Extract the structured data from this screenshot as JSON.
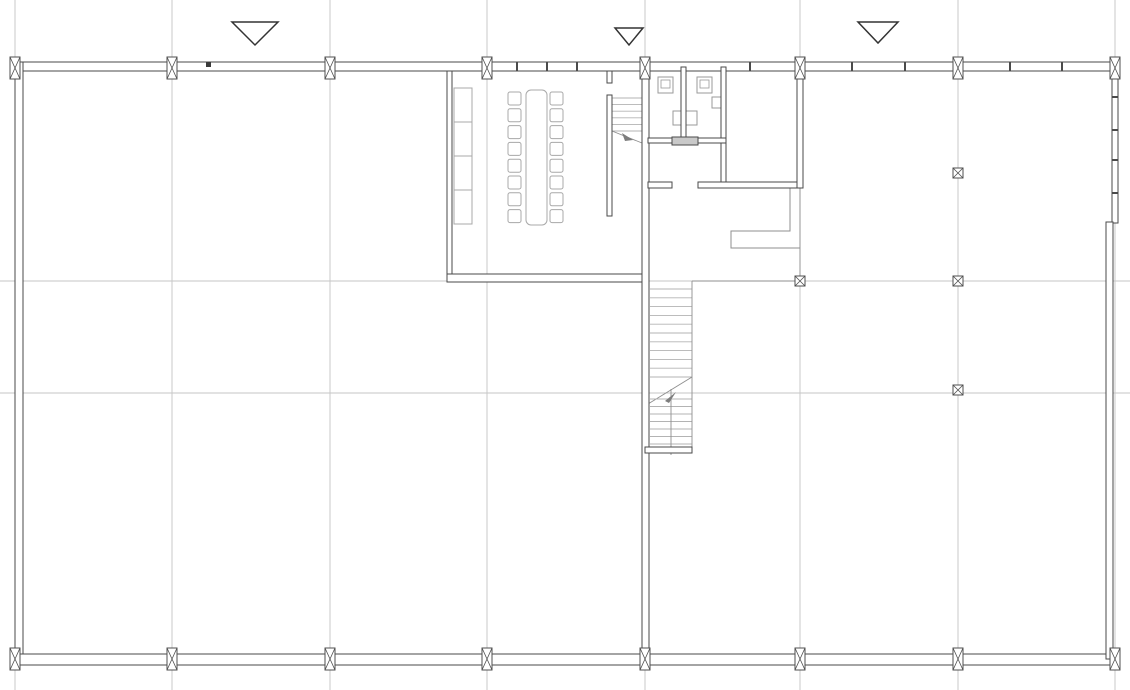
{
  "colors": {
    "background": "#ffffff",
    "grid": "#c5c5c5",
    "wall_stroke": "#4a4a4a",
    "wall_fill": "#ffffff",
    "wall_light": "#7d7d7d",
    "edge_line": "#8f8f8f",
    "tread": "#b3b3b3",
    "furniture": "#a8a8a8",
    "fixture": "#9a9a9a",
    "marker": "#4f4f4f",
    "triangle": "#333333",
    "dot": "#3a3a3a",
    "thick_fill": "#c9c9c9"
  },
  "plan": {
    "canvas": {
      "w": 1130,
      "h": 690
    },
    "gridlines": {
      "vertical_x": [
        15,
        172,
        330,
        487,
        645,
        800,
        958,
        1115
      ],
      "horizontal_y": [
        281,
        393
      ]
    },
    "triangles": [
      {
        "name": "section-marker-large-left",
        "points": "232,22 278,22 255,45"
      },
      {
        "name": "section-marker-small-mid",
        "points": "615,28 643,28 629,45"
      },
      {
        "name": "section-marker-large-right",
        "points": "858,22 898,22 878,43"
      }
    ],
    "walls": [
      {
        "name": "top-wall",
        "x": 10,
        "y": 62,
        "w": 1110,
        "h": 9
      },
      {
        "name": "left-wall",
        "x": 15,
        "y": 62,
        "w": 8,
        "h": 600
      },
      {
        "name": "bottom-wall",
        "x": 10,
        "y": 654,
        "w": 1110,
        "h": 11
      },
      {
        "name": "right-wall-upper",
        "x": 1112,
        "y": 71,
        "w": 6,
        "h": 152
      },
      {
        "name": "right-wall-lower",
        "x": 1106,
        "y": 222,
        "w": 7,
        "h": 437
      },
      {
        "name": "meeting-room-left-wall",
        "x": 447,
        "y": 71,
        "w": 5,
        "h": 206
      },
      {
        "name": "meeting-room-bottom-wall",
        "x": 447,
        "y": 274,
        "w": 202,
        "h": 8
      },
      {
        "name": "core-wall",
        "x": 642,
        "y": 71,
        "w": 7,
        "h": 588
      },
      {
        "name": "meeting-stair-wall-stub",
        "x": 607,
        "y": 71,
        "w": 5,
        "h": 12
      },
      {
        "name": "meeting-stair-wall",
        "x": 607,
        "y": 95,
        "w": 5,
        "h": 121
      },
      {
        "name": "wc-divider-wall",
        "x": 681,
        "y": 67,
        "w": 5,
        "h": 74
      },
      {
        "name": "wc-right-wall",
        "x": 721,
        "y": 67,
        "w": 5,
        "h": 121
      },
      {
        "name": "wc-bottom-wall",
        "x": 648,
        "y": 138,
        "w": 78,
        "h": 5
      },
      {
        "name": "corridor-wall-west",
        "x": 648,
        "y": 182,
        "w": 24,
        "h": 6
      },
      {
        "name": "corridor-wall-east",
        "x": 698,
        "y": 182,
        "w": 105,
        "h": 6
      },
      {
        "name": "lobby-wall",
        "x": 797,
        "y": 71,
        "w": 6,
        "h": 117
      },
      {
        "name": "stair-landing-wall",
        "x": 645,
        "y": 447,
        "w": 47,
        "h": 6
      }
    ],
    "thick_segments": [
      {
        "name": "wc-bottom-wall-thick",
        "x": 672,
        "y": 137,
        "w": 26,
        "h": 8
      }
    ],
    "lines": [
      {
        "name": "stair-open-edge",
        "x1": 692,
        "y1": 281,
        "x2": 692,
        "y2": 453
      },
      {
        "name": "landing-edge",
        "x1": 692,
        "y1": 281,
        "x2": 797,
        "y2": 281
      },
      {
        "name": "lobby-gridline-stub",
        "x1": 800,
        "y1": 188,
        "x2": 800,
        "y2": 281
      },
      {
        "name": "core-wall-joint",
        "x1": 642,
        "y1": 546,
        "x2": 649,
        "y2": 546
      },
      {
        "name": "core-wall-joint",
        "x1": 642,
        "y1": 589,
        "x2": 649,
        "y2": 589
      },
      {
        "name": "meeting-wall-joint",
        "x1": 447,
        "y1": 251,
        "x2": 452,
        "y2": 251
      }
    ],
    "polylines": [
      {
        "name": "reception-counter",
        "points": "790,188 790,231 731,231 731,248 800,248"
      }
    ],
    "stairs": [
      {
        "name": "meeting-room-stair",
        "x1": 612,
        "x2": 642,
        "y_start": 98,
        "step": 6.6,
        "count": 6,
        "diagonal": {
          "x1": 612,
          "y1": 131,
          "x2": 642,
          "y2": 143
        }
      },
      {
        "name": "main-stair-upper-flight",
        "x1": 650,
        "x2": 692,
        "y_start": 289,
        "step": 8.8,
        "count": 11,
        "diagonal": {
          "x1": 648,
          "y1": 404,
          "x2": 692,
          "y2": 377
        }
      },
      {
        "name": "main-stair-lower-flight",
        "x1": 650,
        "x2": 692,
        "y_start": 399,
        "step": 7.5,
        "count": 8,
        "rail": {
          "x1": 671,
          "y1": 389,
          "x2": 671,
          "y2": 455
        }
      }
    ],
    "arrows": [
      {
        "name": "stair-direction-arrow",
        "points": "633,140 622,133 625,141"
      },
      {
        "name": "stair-direction-arrow",
        "points": "665,401 676,392 669,403"
      }
    ],
    "furniture": {
      "cabinet": {
        "x": 454,
        "y": 88,
        "w": 18,
        "h": 136,
        "dividers_y": [
          122,
          156,
          190
        ]
      },
      "table": {
        "x": 526,
        "y": 90,
        "w": 21,
        "h": 135,
        "radius": 5
      },
      "chairs": {
        "size": 13,
        "left_x": 508,
        "right_x": 550,
        "y_start": 92,
        "step": 16.8,
        "count": 8,
        "radius": 2
      },
      "wc_fixtures": [
        {
          "name": "toilet",
          "x": 658,
          "y": 77,
          "w": 15,
          "h": 16,
          "inner": true
        },
        {
          "name": "toilet",
          "x": 697,
          "y": 77,
          "w": 15,
          "h": 16,
          "inner": true
        },
        {
          "name": "sink",
          "x": 712,
          "y": 97,
          "w": 10,
          "h": 11,
          "inner": false
        },
        {
          "name": "double-sink",
          "x": 673,
          "y": 111,
          "w": 24,
          "h": 14,
          "split": true
        }
      ]
    },
    "columns": {
      "top": {
        "y": 57,
        "w": 10,
        "h": 22,
        "x_list": [
          15,
          172,
          330,
          487,
          645,
          800,
          958,
          1115
        ]
      },
      "bottom": {
        "y": 648,
        "w": 10,
        "h": 22,
        "x_list": [
          15,
          172,
          330,
          487,
          645,
          800,
          958,
          1115
        ]
      },
      "field": {
        "size": 10,
        "points": [
          [
            800,
            281
          ],
          [
            958,
            173
          ],
          [
            958,
            281
          ],
          [
            958,
            390
          ]
        ]
      }
    },
    "mullion_ticks": {
      "top_wall_x": [
        517,
        547,
        577,
        750,
        852,
        905,
        1010,
        1062
      ],
      "top_wall_band": {
        "y1": 62,
        "y2": 71
      },
      "right_wall_y": [
        97,
        130,
        160,
        193
      ],
      "right_wall_band": {
        "x1": 1112,
        "x2": 1118
      }
    },
    "door_dot": {
      "x": 206,
      "y": 62,
      "size": 5
    }
  }
}
